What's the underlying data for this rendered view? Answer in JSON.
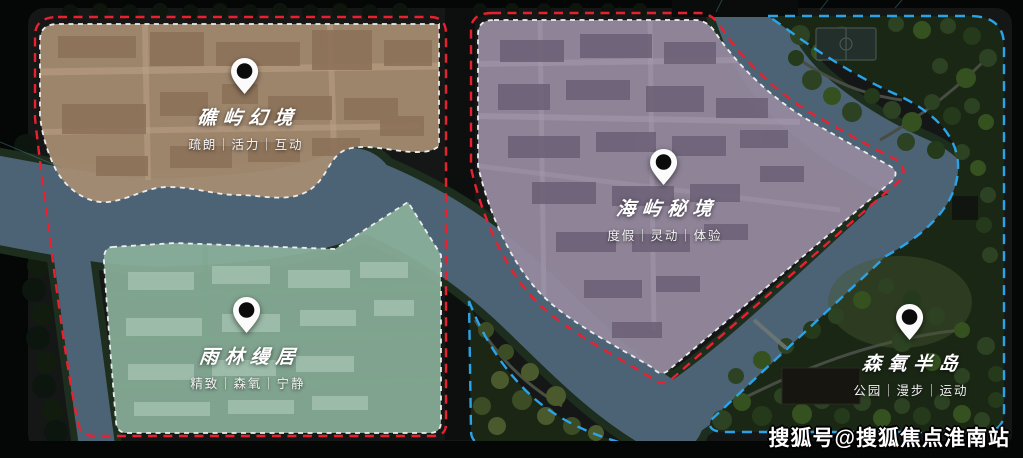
{
  "map": {
    "zones": [
      {
        "name": "礁屿幻境",
        "tags": "疏朗｜活力｜互动"
      },
      {
        "name": "海屿秘境",
        "tags": "度假｜灵动｜体验"
      },
      {
        "name": "雨林缦居",
        "tags": "精致｜森氧｜宁静"
      },
      {
        "name": "森氧半岛",
        "tags": "公园｜漫步｜运动"
      }
    ],
    "watermark": "搜狐号@搜狐焦点淮南站",
    "colors": {
      "background": "#050707",
      "site_boundary_red": "#e9202f",
      "park_boundary_blue": "#2aa3e9",
      "zone_outline_white": "#f3f3f3",
      "zone_reef_brown": "#a68c72",
      "zone_island_purple": "#95899e",
      "zone_rainforest_green": "#8ab09a",
      "river_blue": "#4c6375",
      "park_green": "#1b2715",
      "pin_white": "#fbfbfb",
      "pin_dot_black": "#0b0b0b"
    }
  }
}
